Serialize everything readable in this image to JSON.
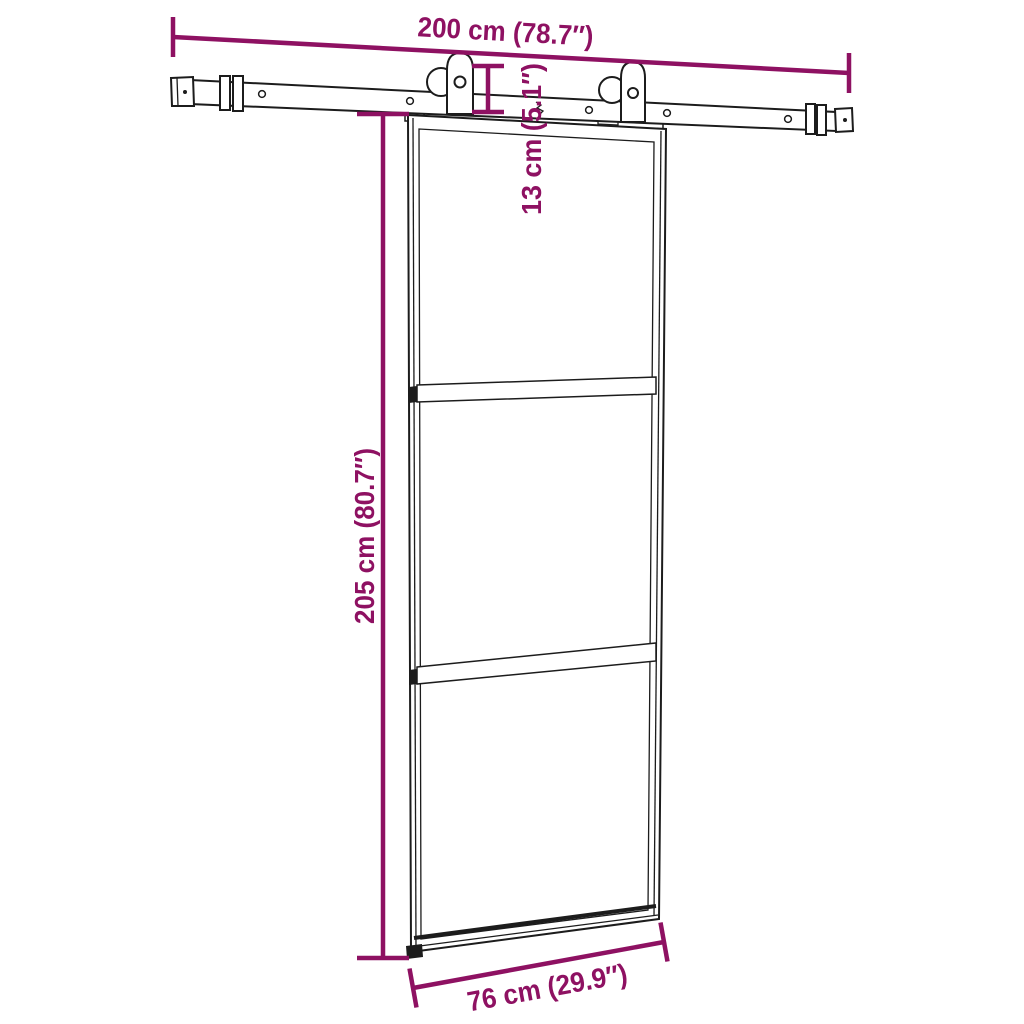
{
  "colors": {
    "dimension": "#8e1162",
    "line": "#1c1c1c",
    "background": "#ffffff"
  },
  "dimensions": {
    "track_length": {
      "label": "200 cm (78.7″)",
      "cm": 200,
      "inch": 78.7
    },
    "hanger_height": {
      "label": "13 cm (5.1″)",
      "cm": 13,
      "inch": 5.1
    },
    "door_height": {
      "label": "205 cm (80.7″)",
      "cm": 205,
      "inch": 80.7
    },
    "door_width": {
      "label": "76 cm (29.9″)",
      "cm": 76,
      "inch": 29.9
    }
  }
}
